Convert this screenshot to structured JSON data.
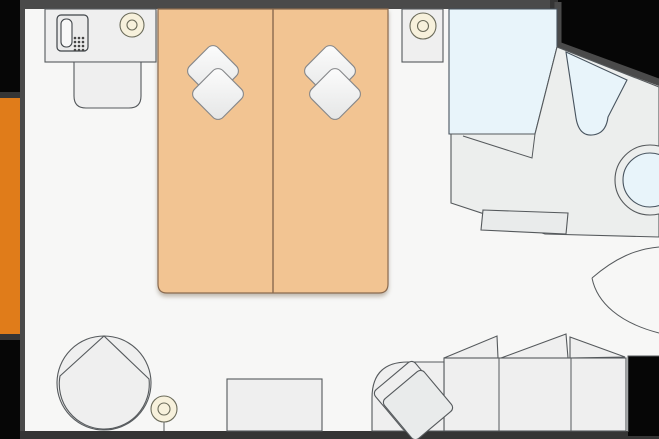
{
  "meta": {
    "view": "hotel-room-floor-plan",
    "canvas": {
      "width": 659,
      "height": 439
    }
  },
  "palette": {
    "floor": "#f7f7f6",
    "wall": "#4a4a4a",
    "wall_dark": "#353535",
    "outside": "#060606",
    "balcony_accent": "#e07c1a",
    "bed": "#f2c492",
    "bed_outline": "#8a6a4f",
    "pillow_light": "#fdfdfd",
    "pillow_dark": "#e4e5e5",
    "furniture": "#efefef",
    "furniture_outline": "#55595c",
    "water": "#e8f4fa",
    "fixture_outline": "#47535e",
    "lamp": "#f7f1dc"
  },
  "furniture": [
    {
      "id": "balcony-strip",
      "kind": "accent-marker",
      "side": "left"
    },
    {
      "id": "console-desk",
      "kind": "desk",
      "items": [
        "telephone",
        "table-lamp"
      ]
    },
    {
      "id": "desk-chair",
      "kind": "chair"
    },
    {
      "id": "twin-bed-left",
      "kind": "bed",
      "pillows": 2
    },
    {
      "id": "twin-bed-right",
      "kind": "bed",
      "pillows": 2
    },
    {
      "id": "nightstand",
      "kind": "nightstand",
      "items": [
        "table-lamp"
      ]
    },
    {
      "id": "bathtub",
      "kind": "bath-fixture"
    },
    {
      "id": "bathroom-counter",
      "kind": "angled-counter",
      "items": [
        "basin",
        "sink-bowl",
        "bath-mat"
      ]
    },
    {
      "id": "entry-door-swing",
      "kind": "door-arc",
      "side": "right"
    },
    {
      "id": "sofa",
      "kind": "sofa",
      "seats": 3,
      "corner_cushion": true
    },
    {
      "id": "coffee-table",
      "kind": "table"
    },
    {
      "id": "armchair",
      "kind": "chair"
    },
    {
      "id": "floor-lamp",
      "kind": "lamp"
    }
  ]
}
